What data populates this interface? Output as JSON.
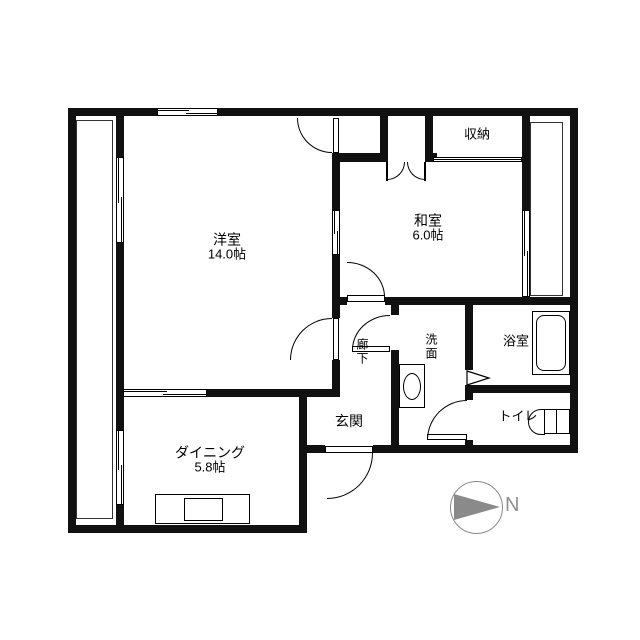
{
  "rooms": {
    "western_room": {
      "name": "洋室",
      "size": "14.0帖"
    },
    "japanese_room": {
      "name": "和室",
      "size": "6.0帖"
    },
    "dining": {
      "name": "ダイニング",
      "size": "5.8帖"
    },
    "storage": {
      "name": "収納"
    },
    "washroom": {
      "name": "洗面"
    },
    "bathroom": {
      "name": "浴室"
    },
    "toilet": {
      "name": "トイレ"
    },
    "entrance": {
      "name": "玄関"
    },
    "hallway": {
      "name": "廊下"
    }
  },
  "compass": {
    "north_label": "N"
  }
}
